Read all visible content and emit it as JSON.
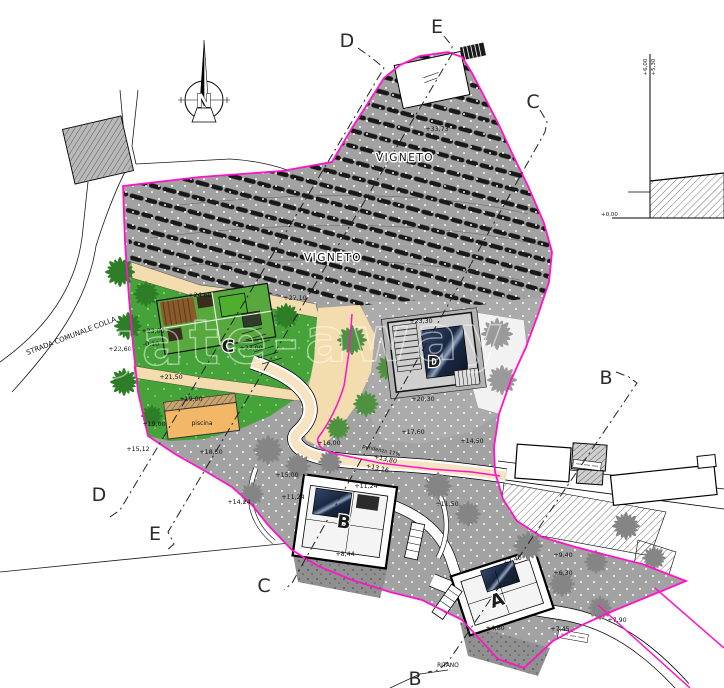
{
  "colors": {
    "magenta": "#ff14c9",
    "vineyard_grey": "#a2a2a2",
    "platform_grey": "#ababab",
    "garden_green": "#46a339",
    "sand": "#f3dcae",
    "road_tan": "#f6e3c2",
    "pool_blue": "#1d2c49",
    "palm_green": "#2e7d27",
    "palm_grey": "#858585",
    "vine_row": "#181818"
  },
  "compass": {
    "label": "N"
  },
  "watermark": {
    "text": "gate-away"
  },
  "labels": {
    "areas": [
      {
        "t": "VIGNETO",
        "x": 405,
        "y": 161,
        "s": 10.5,
        "halo": true,
        "ls": 1.5
      },
      {
        "t": "VIGNETO",
        "x": 333,
        "y": 261,
        "s": 10.5,
        "halo": true,
        "ls": 1.5
      },
      {
        "t": "STRADA COMUNALE COLLA",
        "x": 72,
        "y": 338,
        "s": 7,
        "r": -21
      },
      {
        "t": "piscina",
        "x": 202,
        "y": 425,
        "s": 6
      },
      {
        "t": "RITANO",
        "x": 448,
        "y": 667,
        "s": 5.8
      },
      {
        "t": "pendenza 17%",
        "x": 381,
        "y": 452,
        "s": 5.2,
        "r": 13
      }
    ],
    "elevations": [
      {
        "t": "+22,60",
        "x": 120,
        "y": 351
      },
      {
        "t": "+33,73",
        "x": 437,
        "y": 131
      },
      {
        "t": "+24,60",
        "x": 200,
        "y": 297
      },
      {
        "t": "+23,00",
        "x": 153,
        "y": 333
      },
      {
        "t": "-0,10",
        "x": 151,
        "y": 346
      },
      {
        "t": "+23,00",
        "x": 251,
        "y": 350
      },
      {
        "t": "+27,10",
        "x": 295,
        "y": 300
      },
      {
        "t": "+21,50",
        "x": 171,
        "y": 379
      },
      {
        "t": "+19,00",
        "x": 191,
        "y": 401
      },
      {
        "t": "+19,00",
        "x": 154,
        "y": 426
      },
      {
        "t": "+18,50",
        "x": 211,
        "y": 454
      },
      {
        "t": "+15,12",
        "x": 138,
        "y": 451
      },
      {
        "t": "+14,24",
        "x": 239,
        "y": 504
      },
      {
        "t": "+16,00",
        "x": 329,
        "y": 445
      },
      {
        "t": "+13,80",
        "x": 385,
        "y": 461,
        "r": 13
      },
      {
        "t": "+13,16",
        "x": 377,
        "y": 470,
        "r": 13
      },
      {
        "t": "+17,60",
        "x": 413,
        "y": 434
      },
      {
        "t": "+14,50",
        "x": 472,
        "y": 443
      },
      {
        "t": "+23,30",
        "x": 421,
        "y": 323
      },
      {
        "t": "+20,30",
        "x": 423,
        "y": 401
      },
      {
        "t": "+11,24",
        "x": 366,
        "y": 488
      },
      {
        "t": "+11,24",
        "x": 293,
        "y": 499
      },
      {
        "t": "+15,00",
        "x": 287,
        "y": 477
      },
      {
        "t": "+11,50",
        "x": 447,
        "y": 506
      },
      {
        "t": "+8,44",
        "x": 345,
        "y": 556
      },
      {
        "t": "+7,40",
        "x": 513,
        "y": 562,
        "r": -18
      },
      {
        "t": "+9,40",
        "x": 563,
        "y": 557
      },
      {
        "t": "+6,30",
        "x": 563,
        "y": 575
      },
      {
        "t": "+4,60",
        "x": 495,
        "y": 630
      },
      {
        "t": "+7,45",
        "x": 560,
        "y": 631
      },
      {
        "t": "+7,90",
        "x": 617,
        "y": 622
      }
    ],
    "houses": [
      {
        "t": "A",
        "x": 499,
        "y": 606,
        "s": 18,
        "r": -18
      },
      {
        "t": "B",
        "x": 343,
        "y": 528,
        "s": 18,
        "r": 8
      },
      {
        "t": "C",
        "x": 228,
        "y": 352,
        "s": 17
      },
      {
        "t": "D",
        "x": 434,
        "y": 367,
        "s": 15
      }
    ],
    "section_markers": [
      {
        "t": "D",
        "x": 347,
        "y": 47,
        "s": 19
      },
      {
        "t": "E",
        "x": 437,
        "y": 33,
        "s": 19
      },
      {
        "t": "C",
        "x": 533,
        "y": 108,
        "s": 19
      },
      {
        "t": "B",
        "x": 606,
        "y": 384,
        "s": 19
      },
      {
        "t": "D",
        "x": 99,
        "y": 501,
        "s": 19
      },
      {
        "t": "E",
        "x": 155,
        "y": 540,
        "s": 19
      },
      {
        "t": "C",
        "x": 264,
        "y": 592,
        "s": 19
      },
      {
        "t": "B",
        "x": 415,
        "y": 685,
        "s": 19
      }
    ],
    "section_detail": [
      {
        "t": "+6,00",
        "x": 647,
        "y": 67,
        "s": 5.5,
        "r": -90
      },
      {
        "t": "+5,30",
        "x": 655,
        "y": 67,
        "s": 5.5,
        "r": -90
      },
      {
        "t": "+0,00",
        "x": 601,
        "y": 216,
        "s": 5.5,
        "a": "start"
      }
    ]
  }
}
